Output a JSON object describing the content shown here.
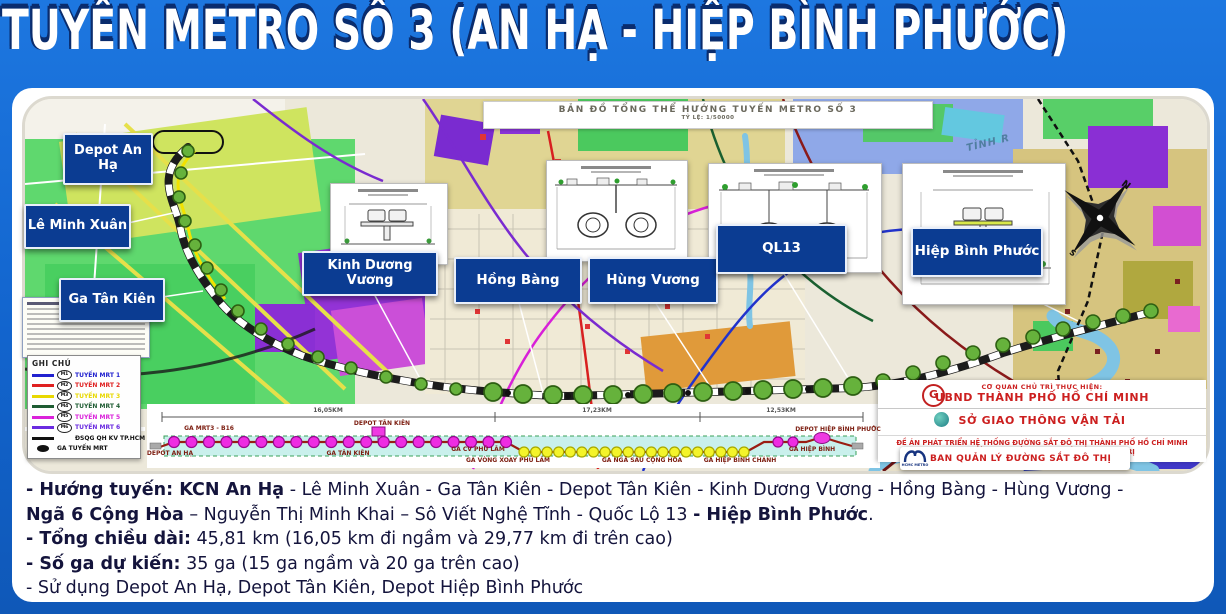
{
  "slide": {
    "title": "TUYẾN METRO SỐ 3 (AN HẠ - HIỆP BÌNH PHƯỚC)"
  },
  "map": {
    "title": "BẢN ĐỒ TỔNG THỂ HƯỚNG TUYẾN METRO SỐ 3",
    "scale": "TỶ LỆ: 1/50000",
    "road_label": "TỈNH R",
    "compass": {
      "north": "N",
      "south": "S"
    },
    "station_labels": [
      {
        "label": "Depot An Hạ"
      },
      {
        "label": "Lê Minh Xuân"
      },
      {
        "label": "Ga Tân Kiên"
      },
      {
        "label": "Kinh Dương Vương"
      },
      {
        "label": "Hồng Bàng"
      },
      {
        "label": "Hùng Vương"
      },
      {
        "label": "QL13"
      },
      {
        "label": "Hiệp Bình Phước"
      }
    ],
    "route_dots": {
      "small": [
        [
          163,
          52
        ],
        [
          156,
          74
        ],
        [
          154,
          98
        ],
        [
          160,
          122
        ],
        [
          170,
          146
        ],
        [
          182,
          169
        ],
        [
          196,
          191
        ],
        [
          213,
          212
        ],
        [
          236,
          230
        ],
        [
          263,
          245
        ],
        [
          293,
          258
        ],
        [
          326,
          269
        ],
        [
          361,
          278
        ],
        [
          396,
          285
        ],
        [
          431,
          290
        ]
      ],
      "large": [
        [
          468,
          293
        ],
        [
          498,
          295
        ],
        [
          528,
          296
        ],
        [
          558,
          296
        ],
        [
          588,
          296
        ],
        [
          618,
          295
        ],
        [
          648,
          294
        ],
        [
          678,
          293
        ],
        [
          708,
          292
        ],
        [
          738,
          291
        ],
        [
          768,
          290
        ],
        [
          798,
          289
        ],
        [
          828,
          287
        ]
      ],
      "ascending": [
        [
          858,
          282
        ],
        [
          888,
          274
        ],
        [
          918,
          264
        ],
        [
          948,
          254
        ],
        [
          978,
          246
        ],
        [
          1008,
          238
        ],
        [
          1038,
          230
        ],
        [
          1068,
          223
        ],
        [
          1098,
          217
        ],
        [
          1126,
          212
        ]
      ],
      "black": [
        [
          483,
          294
        ],
        [
          543,
          297
        ],
        [
          603,
          296
        ],
        [
          663,
          294
        ],
        [
          723,
          292
        ],
        [
          783,
          290
        ]
      ]
    }
  },
  "legend": {
    "title": "GHI CHÚ",
    "items": [
      {
        "badge": "M1",
        "label": "TUYẾN MRT 1",
        "color": "#2121cf",
        "swatch": "line"
      },
      {
        "badge": "M2",
        "label": "TUYẾN MRT 2",
        "color": "#df2020",
        "swatch": "line"
      },
      {
        "badge": "M3",
        "label": "TUYẾN MRT 3",
        "color": "#e8d800",
        "swatch": "line"
      },
      {
        "badge": "M4",
        "label": "TUYẾN MRT 4",
        "color": "#1e5c32",
        "swatch": "line"
      },
      {
        "badge": "M5",
        "label": "TUYẾN MRT 5",
        "color": "#da22da",
        "swatch": "line"
      },
      {
        "badge": "M6",
        "label": "TUYẾN MRT 6",
        "color": "#6a2ae0",
        "swatch": "line"
      },
      {
        "badge": "",
        "label": "ĐSQG QH KV TP.HCM",
        "color": "#111111",
        "swatch": "line"
      },
      {
        "badge": "",
        "label": "GA TUYẾN MRT",
        "color": "#111111",
        "swatch": "station"
      }
    ]
  },
  "schematic": {
    "distance_labels": [
      {
        "text": "16,05KM",
        "x": 328,
        "y": 407
      },
      {
        "text": "17,23KM",
        "x": 597,
        "y": 407
      },
      {
        "text": "12,53KM",
        "x": 781,
        "y": 407
      }
    ],
    "top_labels": [
      {
        "text": "GA MRT3 - B16",
        "x": 209,
        "y": 425
      },
      {
        "text": "DEPOT TÂN KIÊN",
        "x": 382,
        "y": 420
      },
      {
        "text": "DEPOT HIỆP BÌNH PHƯỚC",
        "x": 838,
        "y": 426
      }
    ],
    "bottom_labels": [
      {
        "text": "DEPOT AN HẠ",
        "x": 170,
        "y": 450
      },
      {
        "text": "GA TÂN KIÊN",
        "x": 348,
        "y": 450
      },
      {
        "text": "GA CV PHÚ LÂM",
        "x": 478,
        "y": 446
      },
      {
        "text": "GA VÒNG XOAY PHÚ LÂM",
        "x": 508,
        "y": 457
      },
      {
        "text": "GA NGÃ SÁU CỘNG HÒA",
        "x": 642,
        "y": 457
      },
      {
        "text": "GA HIỆP BÌNH CHÁNH",
        "x": 740,
        "y": 457
      },
      {
        "text": "GA HIỆP BÌNH",
        "x": 812,
        "y": 446
      }
    ],
    "station_counts": {
      "elevated_left": 20,
      "underground": 20,
      "elevated_right": 2
    }
  },
  "info_panel": {
    "row1_small": "CƠ QUAN CHỦ TRÌ THỰC HIỆN:",
    "row1_main": "UBND THÀNH PHỐ HỒ CHÍ MINH",
    "row1_logo_glyph": "G",
    "row2_main": "SỞ GIAO THÔNG VẬN TẢI",
    "overlay_logo_text": "HCMC METRO",
    "overlay_label": "BAN QUẢN LÝ ĐƯỜNG SẮT ĐÔ THỊ",
    "row3": "ĐỀ ÁN PHÁT TRIỂN HỆ THỐNG ĐƯỜNG SẮT ĐÔ THỊ THÀNH PHỐ HỒ CHÍ MINH THEO KẾT LUẬN SỐ 49-KL/TW CỦA BỘ CHÍNH TRỊ"
  },
  "details": {
    "lines": [
      [
        {
          "t": "- Hướng tuyến: KCN An Hạ",
          "b": true
        },
        {
          "t": " - Lê Minh Xuân - Ga Tân Kiên - Depot Tân Kiên - Kinh Dương Vương - Hồng Bàng - Hùng Vương -",
          "b": false
        }
      ],
      [
        {
          "t": "Ngã 6 Cộng Hòa",
          "b": true
        },
        {
          "t": " – Nguyễn Thị Minh Khai – Sô Viết Nghệ Tĩnh  - Quốc Lộ 13 ",
          "b": false
        },
        {
          "t": "- Hiệp Bình Phước",
          "b": true
        },
        {
          "t": ".",
          "b": false
        }
      ],
      [
        {
          "t": "- Tổng chiều dài:",
          "b": true
        },
        {
          "t": " 45,81 km (16,05 km đi ngầm và 29,77 km đi trên cao)",
          "b": false
        }
      ],
      [
        {
          "t": "- Số ga dự kiến:",
          "b": true
        },
        {
          "t": " 35 ga (15 ga ngầm và 20 ga trên cao)",
          "b": false
        }
      ],
      [
        {
          "t": "- Sử dụng Depot An Hạ, Depot Tân Kiên, Depot Hiệp Bình Phước",
          "b": false
        }
      ]
    ]
  },
  "colors": {
    "slide_blue": "#1264cd",
    "label_navy": "#0b3c92",
    "metro_green": "#66b23c",
    "elevated_station": "#ee2ce2",
    "underground_station": "#f4f42a",
    "accent_red": "#cc1f1f"
  }
}
